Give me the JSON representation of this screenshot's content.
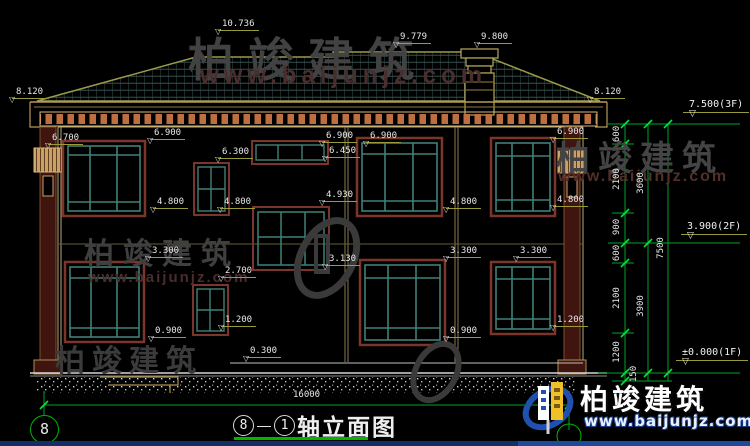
{
  "watermark": {
    "brand": "柏竣建筑",
    "url": "www.baijunjz.com"
  },
  "logo": {
    "brand": "柏竣建筑",
    "url": "www.baijunjz.com"
  },
  "title": {
    "axis_start": "8",
    "axis_sep": "—",
    "axis_end": "1",
    "name": "轴立面图"
  },
  "axes": {
    "left_bubble": "8"
  },
  "dims": {
    "total_width": "16000"
  },
  "elevation_labels": [
    {
      "t": "10.736",
      "x": 218,
      "y": 19
    },
    {
      "t": "9.779",
      "x": 396,
      "y": 32
    },
    {
      "t": "9.800",
      "x": 477,
      "y": 32
    },
    {
      "t": "8.120",
      "x": 12,
      "y": 87
    },
    {
      "t": "8.120",
      "x": 590,
      "y": 87
    },
    {
      "t": "6.700",
      "x": 48,
      "y": 133
    },
    {
      "t": "6.900",
      "x": 150,
      "y": 128
    },
    {
      "t": "6.900",
      "x": 322,
      "y": 131
    },
    {
      "t": "6.900",
      "x": 366,
      "y": 131
    },
    {
      "t": "6.900",
      "x": 553,
      "y": 127
    },
    {
      "t": "6.450",
      "x": 325,
      "y": 146
    },
    {
      "t": "6.300",
      "x": 218,
      "y": 147
    },
    {
      "t": "4.930",
      "x": 322,
      "y": 190
    },
    {
      "t": "4.800",
      "x": 153,
      "y": 197
    },
    {
      "t": "4.800",
      "x": 220,
      "y": 197
    },
    {
      "t": "4.800",
      "x": 446,
      "y": 197
    },
    {
      "t": "4.800",
      "x": 553,
      "y": 195
    },
    {
      "t": "3.300",
      "x": 148,
      "y": 246
    },
    {
      "t": "3.300",
      "x": 446,
      "y": 246
    },
    {
      "t": "3.300",
      "x": 516,
      "y": 246
    },
    {
      "t": "3.130",
      "x": 325,
      "y": 254
    },
    {
      "t": "2.700",
      "x": 221,
      "y": 266
    },
    {
      "t": "1.200",
      "x": 221,
      "y": 315
    },
    {
      "t": "1.200",
      "x": 553,
      "y": 315
    },
    {
      "t": "0.900",
      "x": 151,
      "y": 326
    },
    {
      "t": "0.900",
      "x": 446,
      "y": 326
    },
    {
      "t": "0.300",
      "x": 246,
      "y": 346
    }
  ],
  "floor_labels": [
    {
      "t": "7.500(3F)",
      "x": 683,
      "y": 99
    },
    {
      "t": "3.900(2F)",
      "x": 681,
      "y": 221
    },
    {
      "t": "±0.000(1F)",
      "x": 676,
      "y": 347
    }
  ],
  "vertical_dims": [
    {
      "t": "600",
      "x": 617,
      "y": 134
    },
    {
      "t": "2100",
      "x": 617,
      "y": 179
    },
    {
      "t": "900",
      "x": 617,
      "y": 227
    },
    {
      "t": "600",
      "x": 617,
      "y": 253
    },
    {
      "t": "2100",
      "x": 617,
      "y": 298
    },
    {
      "t": "1200",
      "x": 617,
      "y": 352
    },
    {
      "t": "150",
      "x": 634,
      "y": 374
    },
    {
      "t": "3600",
      "x": 641,
      "y": 183
    },
    {
      "t": "3900",
      "x": 641,
      "y": 306
    },
    {
      "t": "7500",
      "x": 661,
      "y": 248
    }
  ],
  "colors": {
    "dim_green": "#00a428",
    "tick_green": "#00e43c",
    "leader_olive": "#9a9a3a",
    "text": "#e8e8e8",
    "roof_line": "#9a9a4a",
    "tile_line": "#35514e",
    "window_teal": "#418078",
    "window_trim": "#7c352a",
    "cornice_tan": "#c8a068",
    "dentil_orange": "#bd6f42",
    "column_maroon": "#401510",
    "logo_blue": "#2050b0",
    "logo_yellow": "#f0c028",
    "bottom_bar_blue": "#142e66"
  }
}
